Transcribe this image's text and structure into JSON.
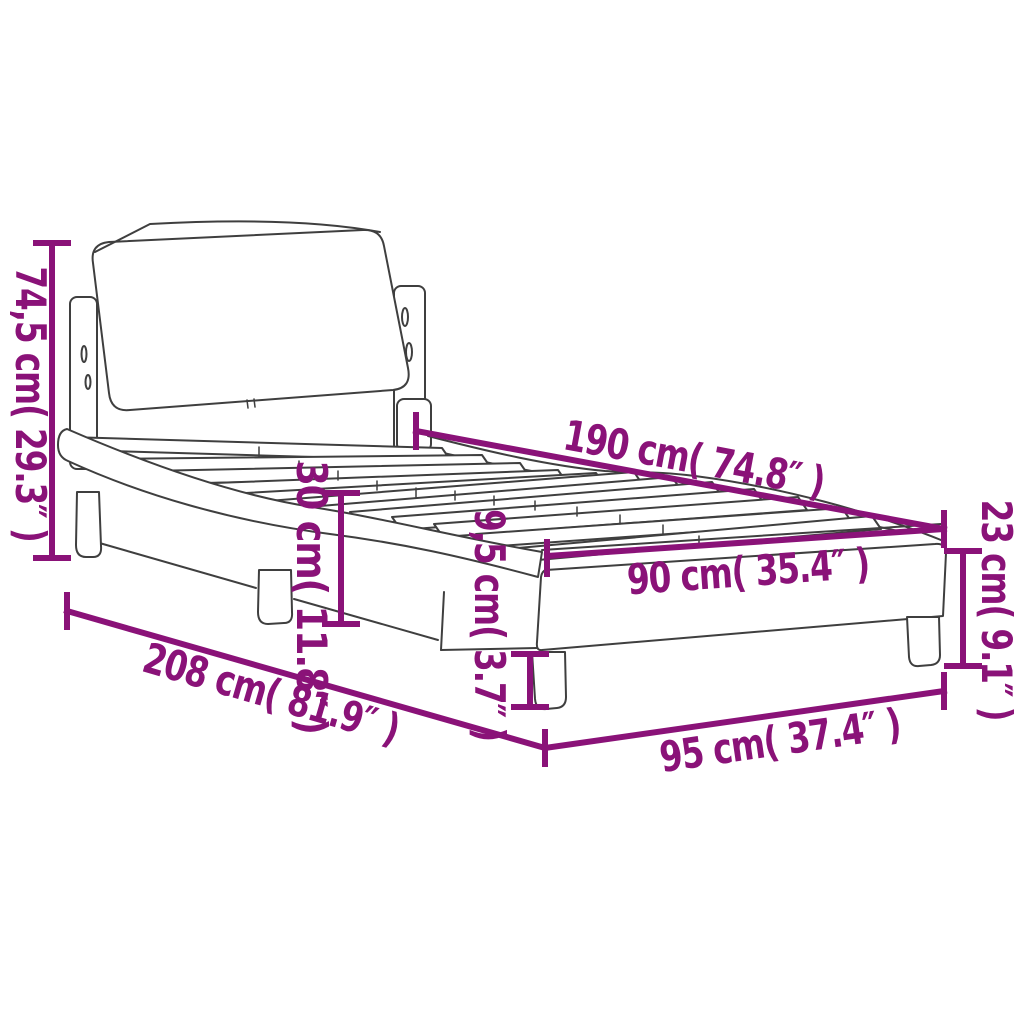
{
  "diagram": {
    "subject": "bed frame with curved side rails, headboard and slatted base",
    "background_color": "#ffffff",
    "line_art_color": "#3f3f3f",
    "dimension_color": "#8a1278",
    "dimensions": {
      "total_height": "74,5 cm( 29.3″ )",
      "slat_length": "190 cm( 74.8″ )",
      "platform_height": "30 cm( 11.8″ )",
      "leg_height": "9,5 cm( 3.7″ )",
      "slat_width": "90 cm( 35.4″ )",
      "frame_height": "23 cm( 9.1″ )",
      "total_length": "208 cm( 81.9″ )",
      "total_width": "95 cm( 37.4″ )"
    }
  }
}
